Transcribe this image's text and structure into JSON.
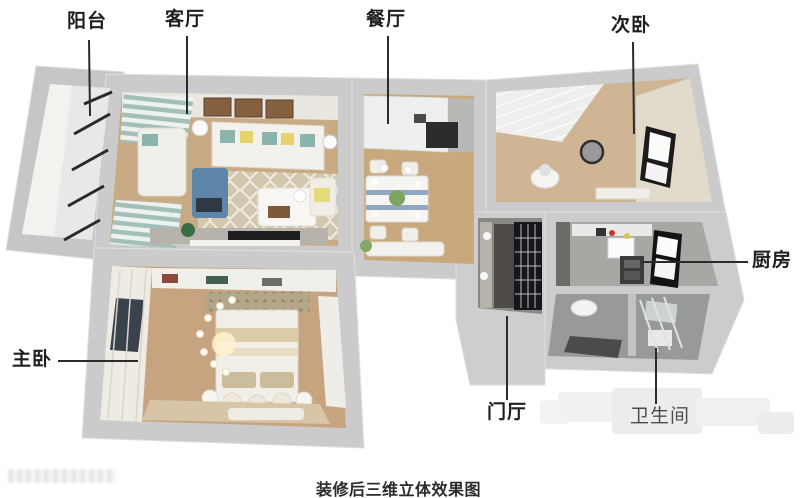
{
  "figure": {
    "type": "3d-floor-plan-rendering",
    "caption": "装修后三维立体效果图"
  },
  "room_labels": {
    "balcony": "阳台",
    "living_room": "客厅",
    "dining_room": "餐厅",
    "second_bedroom": "次卧",
    "kitchen": "厨房",
    "master_bedroom": "主卧",
    "entrance_hall": "门厅",
    "bathroom": "卫生间"
  },
  "palette": {
    "label_text": "#1f1f1f",
    "bathroom_label_text": "#4c4c4c",
    "caption_text": "#2b2b2b",
    "leader_line": "#2b2b2b",
    "wall_gray": "#cbcbcb",
    "wood_floor": "#c9a87e",
    "tile_gray": "#a0a09d",
    "accent_teal": "#8ab5ac",
    "accent_yellow": "#e5d46e",
    "accent_blue": "#5d86a9"
  }
}
